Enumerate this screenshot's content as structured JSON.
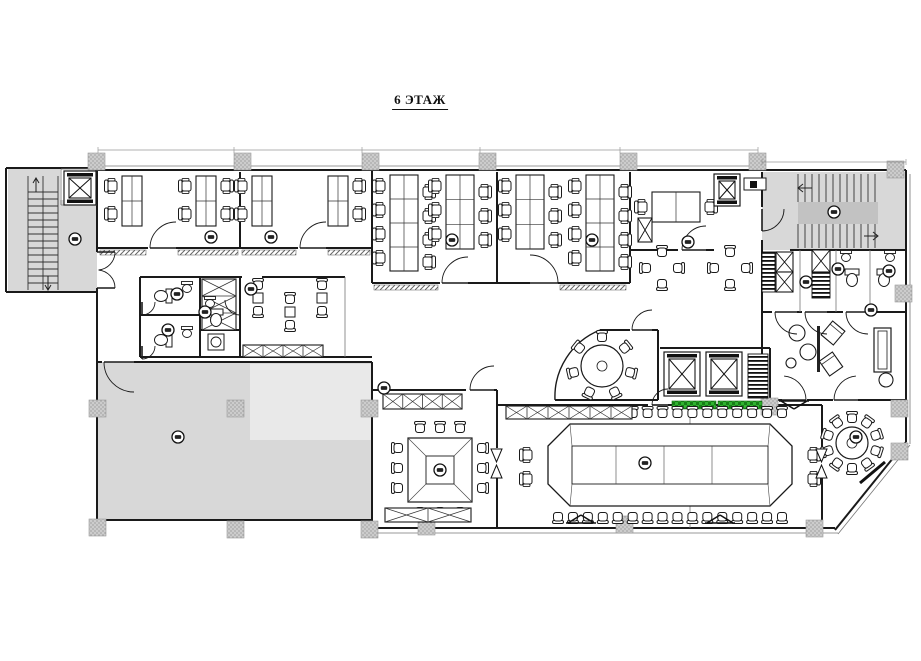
{
  "title": "6 ЭТАЖ",
  "colors": {
    "wall": "#1a1a1a",
    "thin": "#777777",
    "dim": "#999999",
    "gray": "#d8d8d8",
    "light": "#e9e9e9",
    "mid": "#c2c2c2",
    "green": "#2fb32f",
    "white": "#ffffff"
  },
  "inventory": {
    "room_markers": 20,
    "conference_seats": 36,
    "square_table_seats": 12,
    "round_table_center_seats": 7,
    "round_table_corner_seats": 10,
    "elevators": 4,
    "stairwells": 2,
    "desk_banks": 8
  },
  "markers": [
    [
      75,
      239
    ],
    [
      211,
      237
    ],
    [
      271,
      237
    ],
    [
      452,
      240
    ],
    [
      592,
      240
    ],
    [
      688,
      242
    ],
    [
      177,
      294
    ],
    [
      205,
      312
    ],
    [
      168,
      330
    ],
    [
      251,
      289
    ],
    [
      384,
      388
    ],
    [
      178,
      437
    ],
    [
      440,
      470
    ],
    [
      645,
      463
    ],
    [
      856,
      437
    ],
    [
      834,
      212
    ],
    [
      838,
      269
    ],
    [
      889,
      271
    ],
    [
      806,
      282
    ],
    [
      871,
      310
    ]
  ],
  "plan": {
    "areas": [
      {
        "x": 8,
        "y": 168,
        "w": 52,
        "h": 124,
        "f": "gray",
        "name": "stairwell-left-floor"
      },
      {
        "x": 58,
        "y": 200,
        "w": 39,
        "h": 92,
        "f": "gray",
        "name": "lobby-left-floor"
      },
      {
        "x": 762,
        "y": 172,
        "w": 144,
        "h": 78,
        "f": "gray",
        "name": "stairwell-right-floor"
      },
      {
        "x": 798,
        "y": 202,
        "w": 80,
        "h": 22,
        "f": "mid",
        "name": "stair-landing"
      },
      {
        "x": 97,
        "y": 362,
        "w": 275,
        "h": 158,
        "f": "gray",
        "name": "hall-floor"
      },
      {
        "x": 250,
        "y": 364,
        "w": 122,
        "h": 76,
        "f": "light",
        "name": "hall-floor-light"
      }
    ],
    "walls": [
      [
        95,
        170,
        906,
        170
      ],
      [
        906,
        170,
        906,
        442
      ],
      [
        906,
        442,
        835,
        530
      ],
      [
        835,
        528,
        372,
        528
      ],
      [
        372,
        529,
        372,
        362
      ],
      [
        97,
        362,
        102,
        362
      ],
      [
        134,
        362,
        372,
        362
      ],
      [
        97,
        520,
        372,
        520
      ],
      [
        97,
        170,
        97,
        252
      ],
      [
        97,
        288,
        97,
        520
      ],
      [
        6,
        168,
        95,
        168
      ],
      [
        6,
        168,
        6,
        292
      ],
      [
        6,
        292,
        97,
        292
      ],
      [
        240,
        172,
        240,
        248
      ],
      [
        372,
        170,
        372,
        283
      ],
      [
        497,
        172,
        497,
        283
      ],
      [
        630,
        172,
        630,
        283
      ],
      [
        97,
        248,
        148,
        248
      ],
      [
        176,
        248,
        298,
        248
      ],
      [
        326,
        248,
        372,
        248
      ],
      [
        372,
        283,
        440,
        283
      ],
      [
        468,
        283,
        530,
        283
      ],
      [
        558,
        283,
        630,
        283
      ],
      [
        630,
        250,
        678,
        250
      ],
      [
        706,
        250,
        714,
        250
      ],
      [
        140,
        277,
        242,
        277
      ],
      [
        262,
        277,
        345,
        277
      ],
      [
        140,
        277,
        140,
        357
      ],
      [
        140,
        357,
        372,
        357
      ],
      [
        200,
        277,
        200,
        357
      ],
      [
        240,
        277,
        240,
        357
      ],
      [
        140,
        315,
        200,
        315
      ],
      [
        200,
        330,
        240,
        330
      ],
      [
        762,
        172,
        762,
        207
      ],
      [
        762,
        240,
        762,
        250
      ],
      [
        790,
        250,
        906,
        250
      ],
      [
        762,
        250,
        762,
        400
      ],
      [
        762,
        312,
        772,
        312
      ],
      [
        797,
        312,
        802,
        312
      ],
      [
        827,
        312,
        843,
        312
      ],
      [
        868,
        312,
        906,
        312
      ],
      [
        762,
        400,
        782,
        400
      ],
      [
        807,
        400,
        833,
        400
      ],
      [
        858,
        400,
        906,
        400
      ],
      [
        600,
        330,
        630,
        330
      ],
      [
        652,
        330,
        658,
        330
      ],
      [
        658,
        330,
        658,
        400
      ],
      [
        555,
        400,
        658,
        400
      ],
      [
        660,
        348,
        770,
        348
      ],
      [
        770,
        348,
        770,
        400
      ],
      [
        497,
        405,
        648,
        405
      ],
      [
        668,
        405,
        822,
        405
      ],
      [
        372,
        390,
        466,
        390
      ],
      [
        494,
        390,
        497,
        390
      ],
      [
        497,
        390,
        497,
        448
      ],
      [
        497,
        478,
        497,
        528
      ],
      [
        822,
        405,
        822,
        448
      ],
      [
        822,
        478,
        822,
        528
      ]
    ],
    "thin": [
      [
        95,
        166,
        758,
        166
      ],
      [
        372,
        533,
        838,
        533
      ],
      [
        910,
        174,
        910,
        444
      ],
      [
        910,
        445,
        838,
        534
      ],
      [
        345,
        277,
        345,
        357
      ],
      [
        690,
        405,
        690,
        528
      ],
      [
        800,
        250,
        800,
        312
      ],
      [
        836,
        250,
        836,
        312
      ],
      [
        870,
        250,
        870,
        312
      ],
      [
        61,
        169,
        97,
        169
      ],
      [
        61,
        169,
        61,
        205
      ],
      [
        61,
        205,
        97,
        205
      ]
    ],
    "sills": [
      [
        100,
        250,
        46
      ],
      [
        178,
        250,
        60
      ],
      [
        242,
        250,
        54
      ],
      [
        328,
        250,
        42
      ],
      [
        374,
        285,
        64
      ],
      [
        560,
        285,
        66
      ]
    ],
    "columns": [
      [
        88,
        153
      ],
      [
        234,
        153
      ],
      [
        362,
        153
      ],
      [
        479,
        153
      ],
      [
        620,
        153
      ],
      [
        749,
        153
      ],
      [
        887,
        161
      ],
      [
        89,
        400
      ],
      [
        227,
        400
      ],
      [
        361,
        400
      ],
      [
        761,
        398
      ],
      [
        891,
        400
      ],
      [
        891,
        443
      ],
      [
        895,
        285
      ],
      [
        89,
        519
      ],
      [
        227,
        521
      ],
      [
        361,
        521
      ],
      [
        418,
        518
      ],
      [
        616,
        516
      ],
      [
        806,
        520
      ]
    ],
    "green": [
      [
        672,
        401,
        44,
        8
      ],
      [
        718,
        401,
        44,
        8
      ]
    ],
    "stairs": {
      "left": {
        "tx1": 28,
        "tx2": 58,
        "ty0": 192,
        "ty1": 286,
        "step": 7,
        "rails": [
          [
            28,
            176,
            28,
            290
          ],
          [
            58,
            176,
            58,
            290
          ],
          [
            43,
            176,
            43,
            290
          ]
        ]
      },
      "right": {
        "tx0": 798,
        "tx1": 878,
        "step": 7,
        "ty1a": 174,
        "ty2a": 202,
        "ty1b": 224,
        "ty2b": 248
      }
    },
    "arrows": [
      "M36,192 L36,178 M33,183 L36,178 L39,183",
      "M48,276 L48,290 M45,285 L48,290 L51,285",
      "M812,188 L798,188 M803,184 L798,188 L803,192",
      "M864,236 L878,236 M873,232 L878,236 L873,240"
    ],
    "banks": [
      {
        "x": 122,
        "y": 176,
        "w": 20,
        "h": 50,
        "rows": 2,
        "L": [
          186,
          214
        ],
        "R": []
      },
      {
        "x": 196,
        "y": 176,
        "w": 20,
        "h": 50,
        "rows": 2,
        "L": [
          186,
          214
        ],
        "R": [
          186,
          214
        ]
      },
      {
        "x": 252,
        "y": 176,
        "w": 20,
        "h": 50,
        "rows": 2,
        "L": [
          186,
          214
        ],
        "R": []
      },
      {
        "x": 328,
        "y": 176,
        "w": 20,
        "h": 50,
        "rows": 2,
        "L": [],
        "R": [
          186,
          214
        ]
      },
      {
        "x": 390,
        "y": 175,
        "w": 28,
        "h": 96,
        "rows": 4,
        "L": [
          186,
          210,
          234,
          258
        ],
        "R": [
          192,
          216,
          240,
          262
        ]
      },
      {
        "x": 446,
        "y": 175,
        "w": 28,
        "h": 74,
        "rows": 3,
        "L": [
          186,
          210,
          234
        ],
        "R": [
          192,
          216,
          240
        ]
      },
      {
        "x": 516,
        "y": 175,
        "w": 28,
        "h": 74,
        "rows": 3,
        "L": [
          186,
          210,
          234
        ],
        "R": [
          192,
          216,
          240
        ]
      },
      {
        "x": 586,
        "y": 175,
        "w": 28,
        "h": 96,
        "rows": 4,
        "L": [
          186,
          210,
          234,
          258
        ],
        "R": [
          192,
          216,
          240,
          262
        ]
      }
    ],
    "exec_desk": {
      "x": 652,
      "y": 192,
      "w": 48,
      "h": 30
    },
    "chairs_extra": [
      [
        642,
        207,
        270
      ],
      [
        710,
        207,
        90
      ]
    ],
    "clusters": [
      [
        662,
        268
      ],
      [
        730,
        268
      ]
    ],
    "pairs": [
      [
        258,
        298
      ],
      [
        290,
        312
      ],
      [
        322,
        298
      ]
    ],
    "conference": {
      "outer": "M548,446 L570,424 L770,424 L792,446 L792,484 L770,506 L570,506 L548,484 Z",
      "inner": [
        572,
        446,
        196,
        38
      ],
      "seams": [
        616,
        664,
        712
      ],
      "connect": [
        [
          570,
          424,
          572,
          446
        ],
        [
          770,
          424,
          768,
          446
        ],
        [
          770,
          506,
          768,
          484
        ],
        [
          570,
          506,
          572,
          484
        ]
      ],
      "top": {
        "y": 413,
        "x0": 558,
        "x1": 782,
        "n": 16
      },
      "bottom": {
        "y": 517
      },
      "ends": [
        [
          527,
          455,
          270
        ],
        [
          527,
          479,
          270
        ],
        [
          813,
          455,
          90
        ],
        [
          813,
          479,
          90
        ]
      ]
    },
    "square_table": {
      "outer": [
        408,
        438,
        64,
        64
      ],
      "inner": [
        426,
        456,
        28,
        28
      ],
      "chairs": [
        [
          420,
          428,
          0
        ],
        [
          440,
          428,
          0
        ],
        [
          460,
          428,
          0
        ],
        [
          420,
          512,
          180
        ],
        [
          440,
          512,
          180
        ],
        [
          460,
          512,
          180
        ],
        [
          398,
          448,
          270
        ],
        [
          398,
          468,
          270
        ],
        [
          398,
          488,
          270
        ],
        [
          482,
          448,
          90
        ],
        [
          482,
          468,
          90
        ],
        [
          482,
          488,
          90
        ]
      ]
    },
    "round_tables": [
      {
        "cx": 602,
        "cy": 366,
        "r": 21,
        "cr": 29,
        "seats": 7
      },
      {
        "cx": 852,
        "cy": 443,
        "r": 16,
        "cr": 25,
        "seats": 10
      }
    ],
    "credenzas": [
      [
        506,
        406,
        126,
        13,
        6
      ],
      [
        383,
        394,
        79,
        15,
        4
      ],
      [
        243,
        345,
        80,
        12,
        4
      ],
      [
        385,
        508,
        86,
        14,
        2
      ],
      [
        202,
        279,
        34,
        51,
        3
      ]
    ],
    "elevators": [
      [
        64,
        171,
        32,
        34
      ],
      [
        714,
        174,
        26,
        32
      ],
      [
        664,
        352,
        36,
        44
      ],
      [
        706,
        352,
        36,
        44
      ]
    ],
    "xboxes": [
      [
        638,
        218,
        14,
        24
      ],
      [
        776,
        252,
        17,
        20
      ],
      [
        776,
        272,
        17,
        20
      ],
      [
        812,
        250,
        18,
        22
      ]
    ],
    "grilles": [
      [
        762,
        252,
        13,
        40
      ],
      [
        748,
        354,
        20,
        44
      ],
      [
        812,
        272,
        18,
        26
      ]
    ],
    "bowties": [
      [
        491,
        449
      ],
      [
        816,
        449
      ]
    ],
    "toilets": [
      [
        163,
        296,
        90
      ],
      [
        163,
        340,
        90
      ],
      [
        216,
        318,
        0
      ],
      [
        852,
        278,
        0
      ],
      [
        884,
        278,
        0
      ]
    ],
    "sinks": [
      [
        187,
        288
      ],
      [
        187,
        333
      ],
      [
        210,
        303
      ],
      [
        846,
        257
      ],
      [
        890,
        257
      ]
    ],
    "washer": [
      208,
      334,
      16
    ],
    "lounge": {
      "poufs": [
        [
          797,
          333,
          8
        ],
        [
          808,
          352,
          8
        ],
        [
          791,
          363,
          5
        ],
        [
          886,
          380,
          7
        ]
      ],
      "screen": [
        817,
        326,
        3,
        46
      ],
      "sofa": [
        874,
        328,
        17,
        44
      ],
      "armchairs": [
        [
          833,
          333,
          40
        ],
        [
          831,
          364,
          -35
        ]
      ]
    },
    "service_box": {
      "outer": [
        744,
        178,
        22,
        12
      ],
      "inner": [
        750,
        181,
        7,
        7
      ]
    },
    "doors": [
      [
        97,
        252,
        18,
        0,
        85
      ],
      [
        97,
        288,
        18,
        0,
        -85
      ],
      [
        176,
        248,
        26,
        180,
        270
      ],
      [
        326,
        248,
        26,
        180,
        270
      ],
      [
        468,
        283,
        26,
        180,
        270
      ],
      [
        530,
        283,
        28,
        0,
        -90
      ],
      [
        706,
        250,
        24,
        180,
        270
      ],
      [
        134,
        362,
        30,
        180,
        90
      ],
      [
        494,
        390,
        24,
        180,
        270
      ],
      [
        652,
        330,
        20,
        180,
        270
      ],
      [
        668,
        405,
        16,
        180,
        270
      ],
      [
        762,
        209,
        22,
        90,
        0
      ],
      [
        797,
        312,
        22,
        180,
        90
      ],
      [
        827,
        312,
        22,
        180,
        90
      ],
      [
        868,
        312,
        22,
        180,
        90
      ],
      [
        142,
        302,
        13,
        90,
        0
      ],
      [
        142,
        346,
        13,
        90,
        0
      ],
      [
        240,
        300,
        15,
        90,
        180
      ],
      [
        782,
        400,
        24,
        0,
        -85
      ],
      [
        858,
        400,
        24,
        180,
        265
      ]
    ],
    "diag_door": [
      860,
      483,
      885,
      462
    ],
    "arc_glass": "M555,400 A72,72 0 0 1 600,330",
    "diffusers": [
      [
        794,
        401,
        0
      ],
      [
        581,
        523,
        180
      ],
      [
        720,
        523,
        180
      ]
    ],
    "dims": {
      "lines": [
        [
          98,
          150,
          758,
          150
        ],
        [
          762,
          162,
          906,
          162
        ]
      ],
      "ticks": [
        98,
        234,
        362,
        480,
        620,
        758,
        762,
        906
      ]
    }
  }
}
